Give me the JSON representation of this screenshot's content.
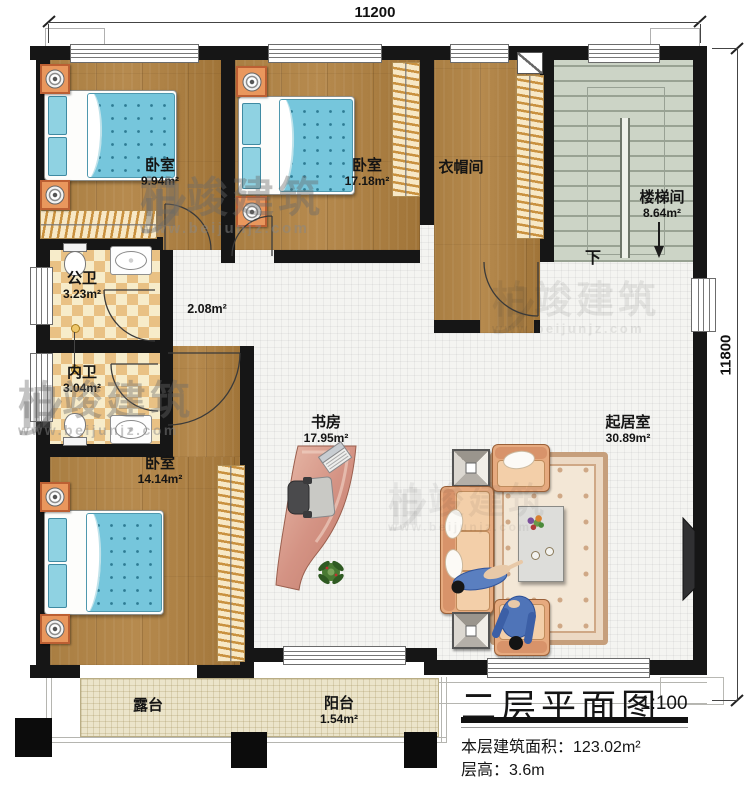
{
  "dimensions": {
    "top": "11200",
    "right": "11800"
  },
  "rooms": {
    "bedroom1": {
      "name": "卧室",
      "area": "9.94m²"
    },
    "bedroom2": {
      "name": "卧室",
      "area": "17.18m²"
    },
    "cloakroom": {
      "name": "衣帽间"
    },
    "stairwell": {
      "name": "楼梯间",
      "area": "8.64m²"
    },
    "bath_public": {
      "name": "公卫",
      "area": "3.23m²"
    },
    "bath_private": {
      "name": "内卫",
      "area": "3.04m²"
    },
    "bedroom3": {
      "name": "卧室",
      "area": "14.14m²"
    },
    "study": {
      "name": "书房",
      "area": "17.95m²"
    },
    "living": {
      "name": "起居室",
      "area": "30.89m²"
    },
    "terrace": {
      "name": "露台"
    },
    "balcony": {
      "name": "阳台",
      "area": "1.54m²"
    },
    "hallway": {
      "area": "2.08m²"
    }
  },
  "stairs": {
    "direction_label": "下"
  },
  "watermark": {
    "brand": "柏竣建筑",
    "url": "www.beijunjz.com"
  },
  "title_block": {
    "title": "二层平面图",
    "scale": "1:100",
    "area_label": "本层建筑面积：",
    "area_value": "123.02m²",
    "height_label": "层高：",
    "height_value": "3.6m"
  },
  "colors": {
    "wall": "#161616",
    "wood": "#a87d41",
    "tile": "#f4f4f1",
    "stair": "#ccd4c6",
    "terrace": "#ebe4ca",
    "quilt": "#76c6dc",
    "sofa": "#e6aa7f"
  }
}
